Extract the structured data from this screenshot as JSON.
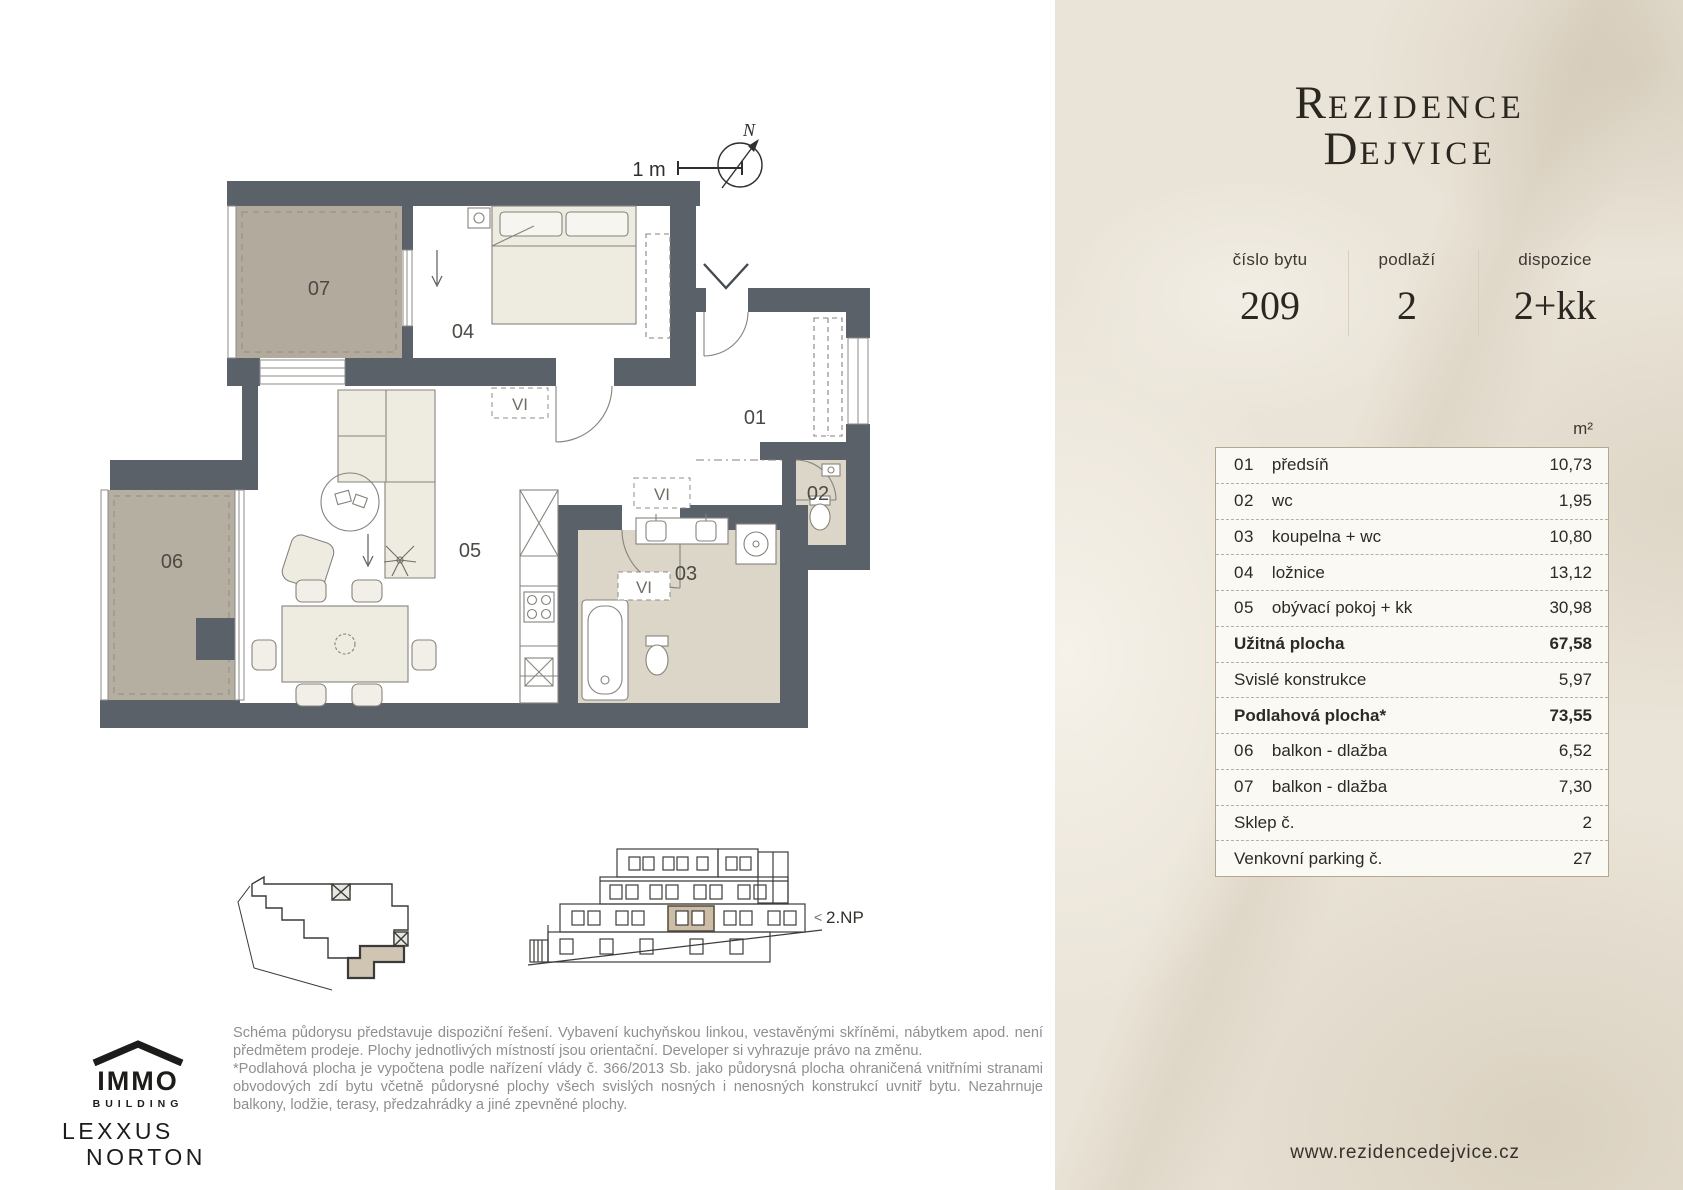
{
  "brand": {
    "title_line1_initial": "R",
    "title_line1_rest": "EZIDENCE",
    "title_line2_initial": "D",
    "title_line2_rest": "EJVICE",
    "website": "www.rezidencedejvice.cz"
  },
  "unit_info": {
    "number_label": "číslo bytu",
    "number_value": "209",
    "floor_label": "podlaží",
    "floor_value": "2",
    "layout_label": "dispozice",
    "layout_value": "2+kk"
  },
  "area_table": {
    "unit_header": "m²",
    "rows": [
      {
        "num": "01",
        "name": "předsíň",
        "value": "10,73",
        "bold": false
      },
      {
        "num": "02",
        "name": "wc",
        "value": "1,95",
        "bold": false
      },
      {
        "num": "03",
        "name": "koupelna + wc",
        "value": "10,80",
        "bold": false
      },
      {
        "num": "04",
        "name": "ložnice",
        "value": "13,12",
        "bold": false
      },
      {
        "num": "05",
        "name": "obývací pokoj + kk",
        "value": "30,98",
        "bold": false
      },
      {
        "num": "",
        "name": "Užitná plocha",
        "value": "67,58",
        "bold": true
      },
      {
        "num": "",
        "name": "Svislé konstrukce",
        "value": "5,97",
        "bold": false
      },
      {
        "num": "",
        "name": "Podlahová plocha*",
        "value": "73,55",
        "bold": true
      },
      {
        "num": "06",
        "name": "balkon - dlažba",
        "value": "6,52",
        "bold": false
      },
      {
        "num": "07",
        "name": "balkon - dlažba",
        "value": "7,30",
        "bold": false
      },
      {
        "num": "",
        "name": "Sklep č.",
        "value": "2",
        "bold": false
      },
      {
        "num": "",
        "name": "Venkovní parking č.",
        "value": "27",
        "bold": false
      }
    ]
  },
  "floor_plan": {
    "scale_label": "1 m",
    "north_label": "N",
    "level_label": "2.NP",
    "level_arrow": "<",
    "vent_label": "VI",
    "rooms": [
      "01",
      "02",
      "03",
      "04",
      "05",
      "06",
      "07"
    ]
  },
  "logos": {
    "immo_name": "IMMO",
    "immo_sub": "BUILDING",
    "lexxus_line1": "LEXXUS",
    "lexxus_line2": "NORTON"
  },
  "disclaimer": {
    "para1": "Schéma půdorysu představuje dispoziční řešení. Vybavení kuchyňskou linkou, vestavěnými skříněmi, nábytkem apod. není předmětem prodeje. Plochy jednotlivých místností jsou orientační. Developer si vyhrazuje právo na změnu.",
    "para2": "*Podlahová plocha je vypočtena podle nařízení vlády č. 366/2013 Sb. jako půdorysná plocha ohraničená vnitřními stranami obvodových zdí bytu včetně půdorysné plochy všech svislých nosných i nenosných konstrukcí uvnitř bytu. Nezahrnuje balkony, lodžie, terasy, předzahrádky a jiné zpevněné plochy."
  },
  "colors": {
    "panel_base": "#eae4d8",
    "wall": "#5b6169",
    "balcony": "#b2ab9d",
    "wet_floor": "#dcd6c8",
    "highlight_unit": "#cdbda6",
    "table_bg": "#fbf9f3",
    "text_dark": "#2b2723"
  }
}
